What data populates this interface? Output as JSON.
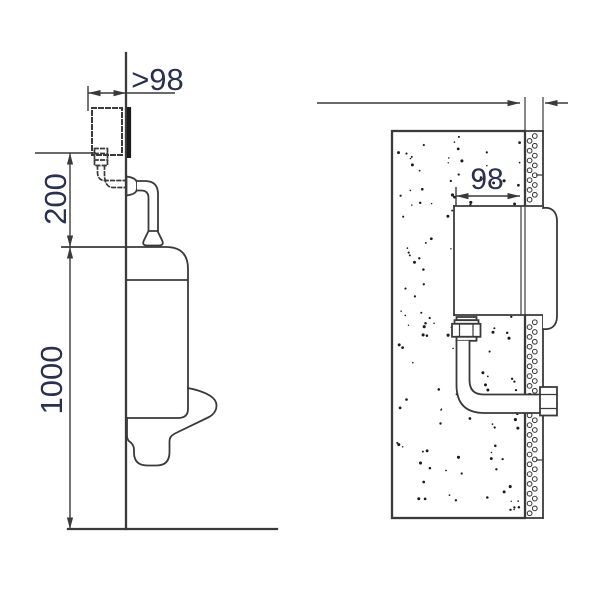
{
  "diagram": {
    "description": "Urinal concealed flush valve installation drawing",
    "side_view": {
      "dim_wall_offset": ">98",
      "dim_valve_height": "200",
      "dim_rim_height": "1000"
    },
    "section_view": {
      "dim_recess_width": "98"
    }
  },
  "colors": {
    "line": "#3a3a3a",
    "text": "#2a3150",
    "dark": "#1b1b1b",
    "bg": "#ffffff"
  }
}
